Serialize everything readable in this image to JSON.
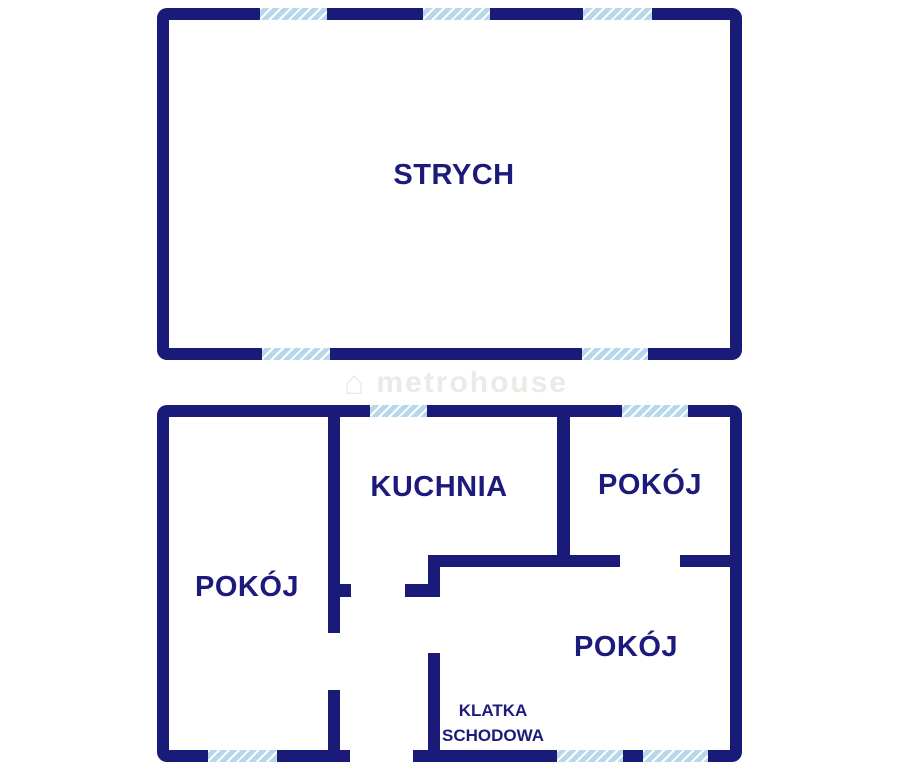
{
  "colors": {
    "wall": "#1a1a78",
    "text": "#1c1a7c",
    "window-fill": "#b7d8ea",
    "window-stripe": "#ffffff",
    "watermark": "#edeae6",
    "bg": "#ffffff"
  },
  "floors": {
    "attic": {
      "rooms": [
        {
          "label": "STRYCH"
        }
      ]
    },
    "ground": {
      "rooms": [
        {
          "label": "POKÓJ"
        },
        {
          "label": "KUCHNIA"
        },
        {
          "label": "POKÓJ"
        },
        {
          "label": "POKÓJ"
        },
        {
          "label": "KLATKA SCHODOWA"
        }
      ]
    }
  },
  "watermark": {
    "icon": "house-icon",
    "icon_glyph": "⌂",
    "text": "metrohouse"
  }
}
